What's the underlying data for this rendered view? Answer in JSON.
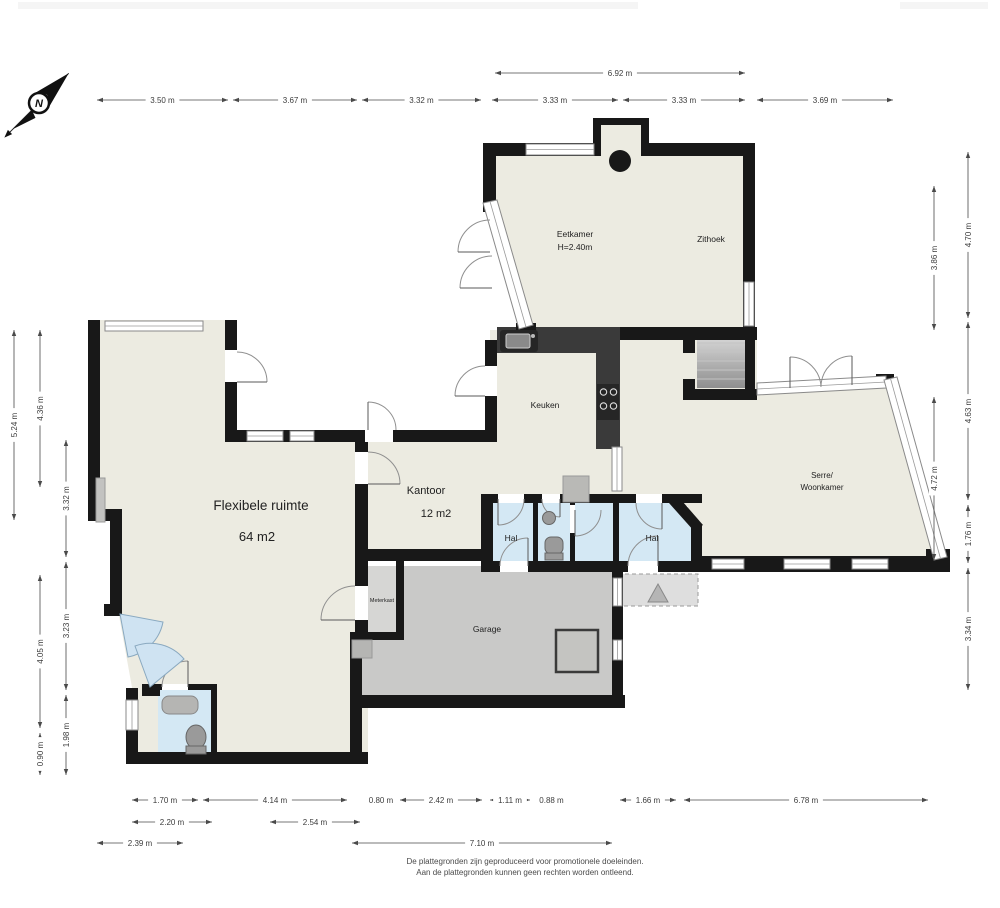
{
  "compass": {
    "label": "N"
  },
  "footer": {
    "line1": "De plattegronden zijn geproduceerd voor promotionele doeleinden.",
    "line2": "Aan de plattegronden kunnen geen rechten worden ontleend."
  },
  "colors": {
    "floor": "#ECEBE1",
    "wall": "#181818",
    "hall_floor": "#D4E8F4",
    "garage_floor": "#C9C9C8",
    "door_glass": "#CFE3F2",
    "porch": "#DEDEDE",
    "counter": "#3A3A3A",
    "dimension_text": "#3C3C3C"
  },
  "rooms": [
    {
      "id": "eetkamer",
      "lines": [
        "Eetkamer",
        "H=2.40m"
      ],
      "x": 575,
      "y": 237,
      "size": 8.5
    },
    {
      "id": "zithoek",
      "lines": [
        "Zithoek"
      ],
      "x": 711,
      "y": 242,
      "size": 8.5
    },
    {
      "id": "keuken",
      "lines": [
        "Keuken"
      ],
      "x": 545,
      "y": 408,
      "size": 8.5
    },
    {
      "id": "serre-woonkamer",
      "lines": [
        "Serre/",
        "Woonkamer"
      ],
      "x": 822,
      "y": 478,
      "size": 8
    },
    {
      "id": "flexibele-ruimte",
      "lines": [
        "Flexibele ruimte"
      ],
      "x": 261,
      "y": 510,
      "size": 13.5
    },
    {
      "id": "flexibele-ruimte-area",
      "lines": [
        "64 m2"
      ],
      "x": 257,
      "y": 541,
      "size": 13
    },
    {
      "id": "kantoor",
      "lines": [
        "Kantoor"
      ],
      "x": 426,
      "y": 494,
      "size": 11
    },
    {
      "id": "kantoor-area",
      "lines": [
        "12 m2"
      ],
      "x": 436,
      "y": 517,
      "size": 11
    },
    {
      "id": "hal-left",
      "lines": [
        "Hal"
      ],
      "x": 511,
      "y": 541,
      "size": 8.5
    },
    {
      "id": "hal-right",
      "lines": [
        "Hal"
      ],
      "x": 652,
      "y": 541,
      "size": 8.5
    },
    {
      "id": "meterkast",
      "lines": [
        "Meterkast"
      ],
      "x": 382,
      "y": 602,
      "size": 5.5
    },
    {
      "id": "garage",
      "lines": [
        "Garage"
      ],
      "x": 487,
      "y": 632,
      "size": 8.5
    }
  ],
  "dimensions": [
    {
      "label": "6.92 m",
      "x1": 495,
      "y1": 73,
      "x2": 745,
      "y2": 73
    },
    {
      "label": "3.50 m",
      "x1": 97,
      "y1": 100,
      "x2": 228,
      "y2": 100
    },
    {
      "label": "3.67 m",
      "x1": 233,
      "y1": 100,
      "x2": 357,
      "y2": 100
    },
    {
      "label": "3.32 m",
      "x1": 362,
      "y1": 100,
      "x2": 481,
      "y2": 100
    },
    {
      "label": "3.33 m",
      "x1": 492,
      "y1": 100,
      "x2": 618,
      "y2": 100
    },
    {
      "label": "3.33 m",
      "x1": 623,
      "y1": 100,
      "x2": 745,
      "y2": 100
    },
    {
      "label": "3.69 m",
      "x1": 757,
      "y1": 100,
      "x2": 893,
      "y2": 100
    },
    {
      "label": "5.24 m",
      "x1": 14,
      "y1": 330,
      "x2": 14,
      "y2": 520
    },
    {
      "label": "4.36 m",
      "x1": 40,
      "y1": 330,
      "x2": 40,
      "y2": 487
    },
    {
      "label": "4.05 m",
      "x1": 40,
      "y1": 575,
      "x2": 40,
      "y2": 728
    },
    {
      "label": "0.90 m",
      "x1": 40,
      "y1": 733,
      "x2": 40,
      "y2": 775
    },
    {
      "label": "3.32 m",
      "x1": 66,
      "y1": 440,
      "x2": 66,
      "y2": 557
    },
    {
      "label": "3.23 m",
      "x1": 66,
      "y1": 562,
      "x2": 66,
      "y2": 690
    },
    {
      "label": "1.98 m",
      "x1": 66,
      "y1": 695,
      "x2": 66,
      "y2": 775
    },
    {
      "label": "3.86 m",
      "x1": 934,
      "y1": 186,
      "x2": 934,
      "y2": 330
    },
    {
      "label": "4.72 m",
      "x1": 934,
      "y1": 397,
      "x2": 934,
      "y2": 560
    },
    {
      "label": "4.70 m",
      "x1": 968,
      "y1": 152,
      "x2": 968,
      "y2": 318
    },
    {
      "label": "4.63 m",
      "x1": 968,
      "y1": 322,
      "x2": 968,
      "y2": 500
    },
    {
      "label": "1.76 m",
      "x1": 968,
      "y1": 505,
      "x2": 968,
      "y2": 563
    },
    {
      "label": "3.34 m",
      "x1": 968,
      "y1": 568,
      "x2": 968,
      "y2": 690
    },
    {
      "label": "1.70 m",
      "x1": 132,
      "y1": 800,
      "x2": 198,
      "y2": 800
    },
    {
      "label": "4.14 m",
      "x1": 203,
      "y1": 800,
      "x2": 347,
      "y2": 800
    },
    {
      "label": "0.80 m",
      "x1": 366,
      "y1": 800,
      "x2": 396,
      "y2": 800
    },
    {
      "label": "2.42 m",
      "x1": 400,
      "y1": 800,
      "x2": 482,
      "y2": 800
    },
    {
      "label": "1.11 m",
      "x1": 490,
      "y1": 800,
      "x2": 530,
      "y2": 800
    },
    {
      "label": "0.88 m",
      "x1": 535,
      "y1": 800,
      "x2": 568,
      "y2": 800
    },
    {
      "label": "1.66 m",
      "x1": 620,
      "y1": 800,
      "x2": 676,
      "y2": 800
    },
    {
      "label": "6.78 m",
      "x1": 684,
      "y1": 800,
      "x2": 928,
      "y2": 800
    },
    {
      "label": "2.20 m",
      "x1": 132,
      "y1": 822,
      "x2": 212,
      "y2": 822
    },
    {
      "label": "2.54 m",
      "x1": 270,
      "y1": 822,
      "x2": 360,
      "y2": 822
    },
    {
      "label": "2.39 m",
      "x1": 97,
      "y1": 843,
      "x2": 183,
      "y2": 843
    },
    {
      "label": "7.10 m",
      "x1": 352,
      "y1": 843,
      "x2": 612,
      "y2": 843
    }
  ]
}
